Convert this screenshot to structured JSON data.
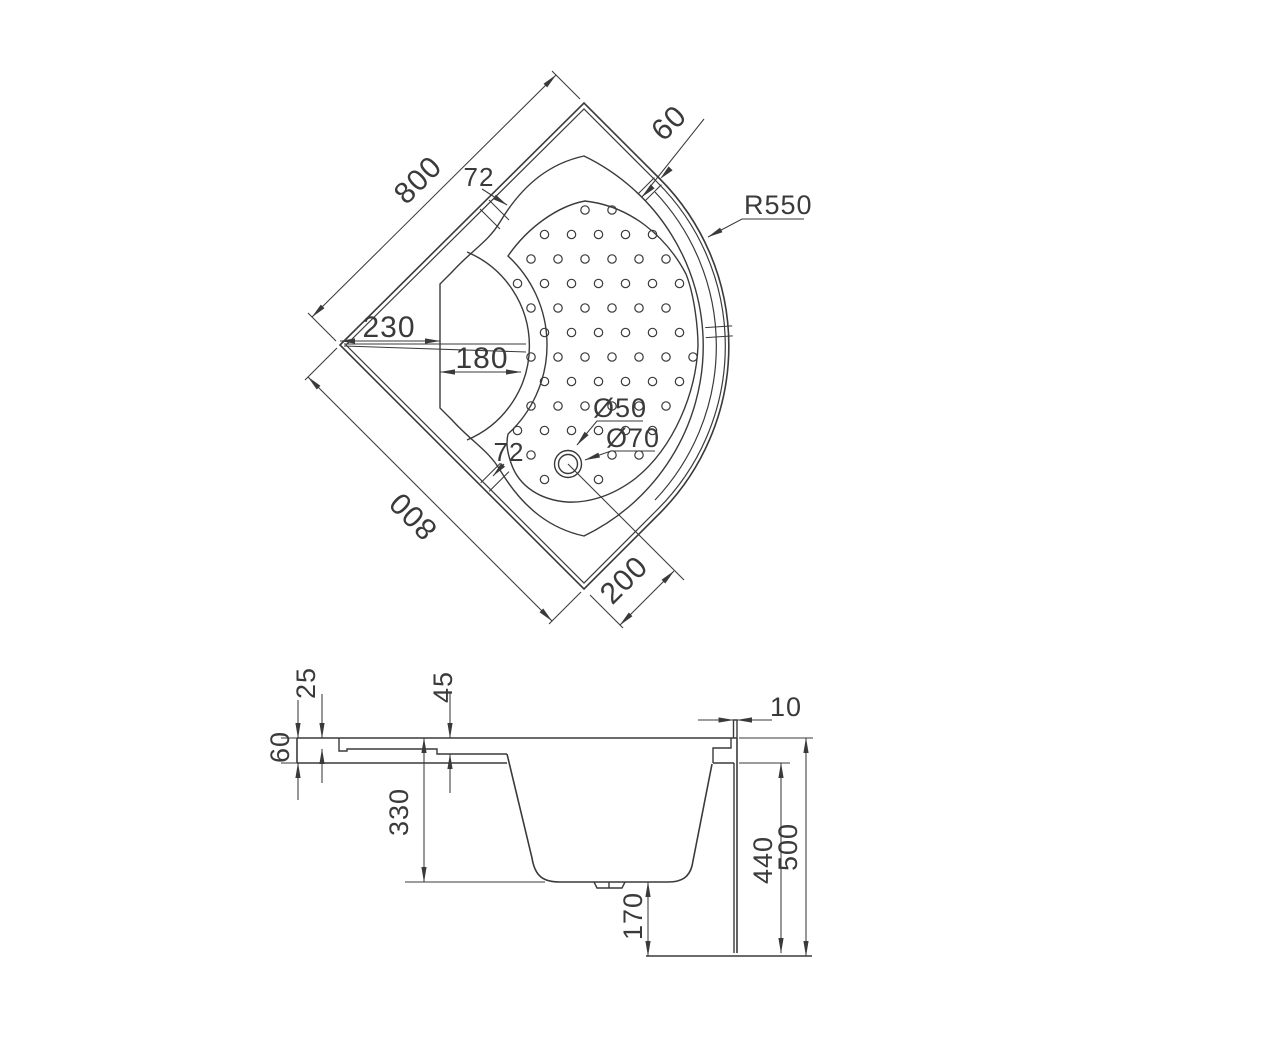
{
  "drawing": {
    "background": "#ffffff",
    "line_color": "#3a3a3a",
    "plan": {
      "dims": {
        "edge_top": "800",
        "edge_bottom": "800",
        "corner_to_seat": "230",
        "seat_width": "180",
        "rim_mark_top": "72",
        "rim_mark_bottom": "72",
        "rim_width": "60",
        "front_radius": "R550",
        "drain_small": "Ø50",
        "drain_large": "Ø70",
        "drain_offset": "200"
      }
    },
    "section": {
      "dims": {
        "lip_depth": "25",
        "ledge_depth": "45",
        "left_edge_height": "60",
        "basin_depth": "330",
        "under_clearance": "170",
        "inner_height": "440",
        "total_height": "500",
        "wall_thickness": "10"
      }
    }
  }
}
